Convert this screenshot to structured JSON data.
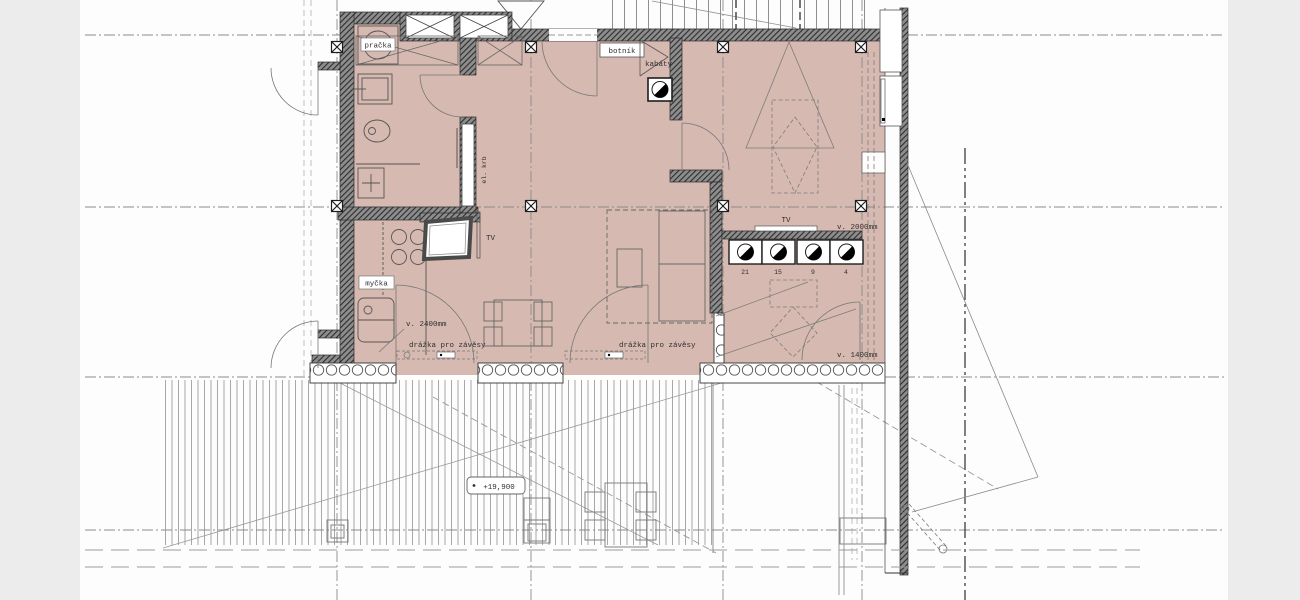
{
  "labels": {
    "washer": "pračka",
    "shoe_cabinet": "botník",
    "coats": "kabáty",
    "electric_fireplace": "el. krb",
    "dishwasher": "myčka",
    "tv_kitchen": "TV",
    "tv_bedroom": "TV",
    "height_2400": "v. 2400mm",
    "height_2000": "v. 2000mm",
    "height_1400": "v. 1400mm",
    "curtain_groove_left": "drážka pro závěsy",
    "curtain_groove_right": "drážka pro závěsy",
    "elevation": "+19,900",
    "step_numbers": [
      "21",
      "15",
      "9",
      "4"
    ]
  },
  "colors": {
    "room_fill": "#d6b9b0",
    "wall": "#3a3a3a",
    "canvas": "#fdfdfd",
    "margin": "#ececec",
    "line": "#666666"
  }
}
